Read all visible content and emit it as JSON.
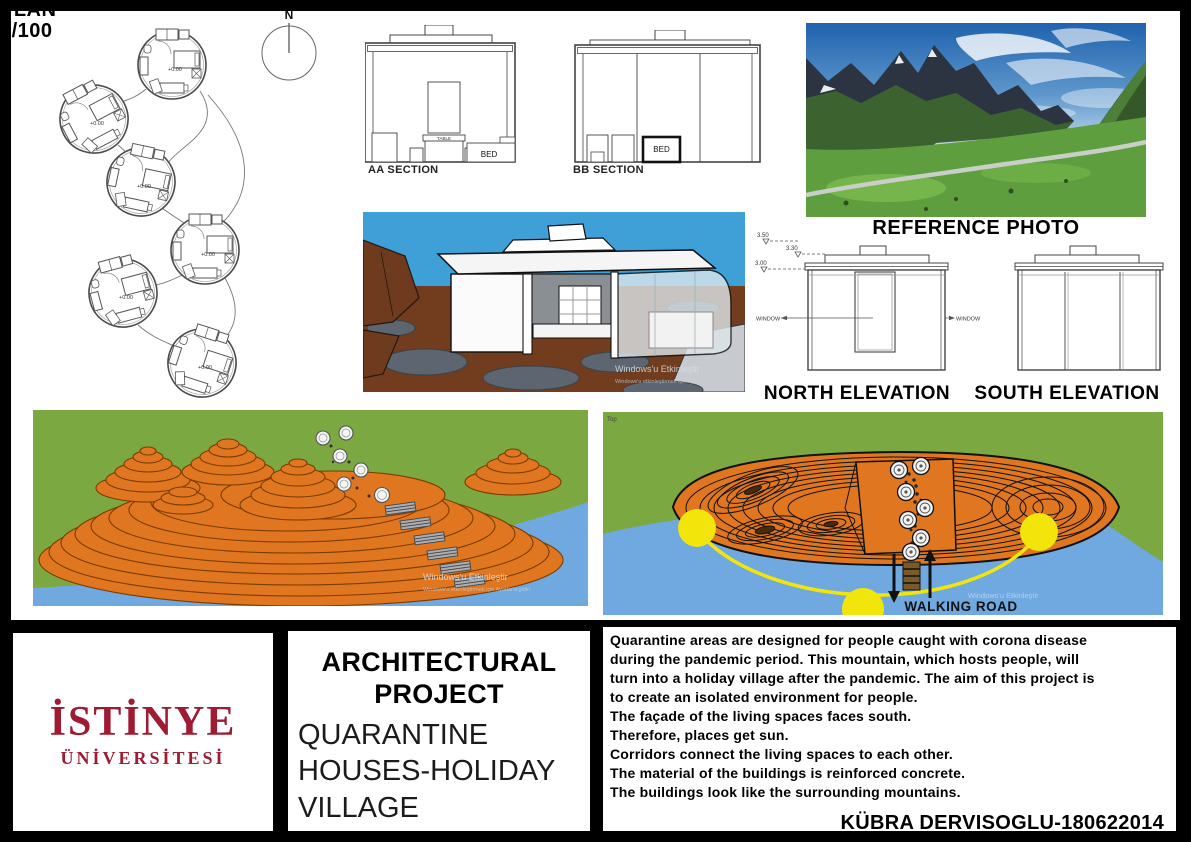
{
  "page": {
    "width": 1191,
    "height": 842
  },
  "colors": {
    "logo_red": "#9E1B33",
    "sky_blue": "#3FA0D8",
    "ground_brown": "#713D1E",
    "rock_gray": "#5C6570",
    "terrain_orange": "#E0761F",
    "grass_green": "#7BA841",
    "water_blue": "#6FA9E0",
    "road_yellow": "#F2E50B"
  },
  "plan": {
    "compass_label": "N",
    "label_line1": "PLAN",
    "label_line2": "1/100",
    "level_label": "+0.00"
  },
  "sections": {
    "aa": {
      "label": "AA SECTION",
      "table_label": "TABLE",
      "bed_label": "BED"
    },
    "bb": {
      "label": "BB SECTION",
      "bed_label": "BED"
    }
  },
  "reference_photo": {
    "label": "REFERENCE PHOTO"
  },
  "elevations": {
    "north_label": "NORTH ELEVATION",
    "south_label": "SOUTH ELEVATION",
    "window_label_left": "WINDOW",
    "window_label_right": "WINDOW",
    "levels": [
      "3.50",
      "3.30",
      "3.00"
    ]
  },
  "watermark": {
    "line1": "Windows'u Etkinleştir",
    "line2": "Windows'u etkinleştirmek için Ayarlar'a gidin."
  },
  "site_plan": {
    "viewport_label": "Top",
    "road_label": "WALKING ROAD"
  },
  "title_block": {
    "university": {
      "line1": "İSTİNYE",
      "line2": "ÜNİVERSİTESİ"
    },
    "project_type": {
      "line1": "ARCHITECTURAL",
      "line2": "PROJECT"
    },
    "project_name": {
      "line1": "QUARANTINE",
      "line2": "HOUSES-HOLIDAY",
      "line3": "VILLAGE"
    },
    "description_lines": [
      "Quarantine areas are designed for people caught with corona disease",
      "during the pandemic period. This mountain, which hosts people, will",
      "turn into a holiday village after the pandemic. The aim of this project is",
      "to create an isolated environment for people.",
      "The façade of the living spaces faces south.",
      "Therefore, places get sun.",
      "Corridors connect the living spaces to each other.",
      "The material of the buildings is reinforced concrete.",
      "The buildings look like the surrounding mountains."
    ],
    "author": "KÜBRA DERVISOGLU-180622014"
  }
}
